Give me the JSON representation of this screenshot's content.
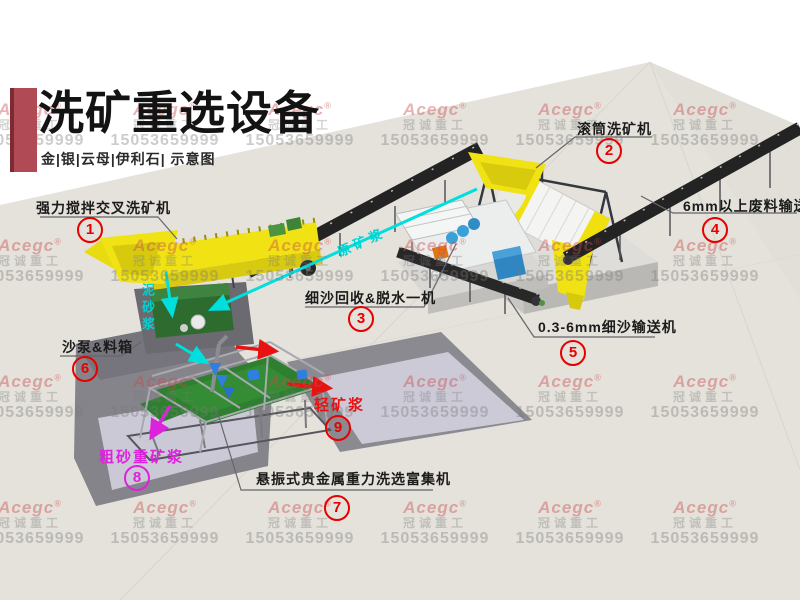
{
  "title_block": {
    "title": "洗矿重选设备",
    "subtitle": "金|银|云母|伊利石| 示意图"
  },
  "watermark": {
    "brand": "Acegc",
    "reg": "®",
    "company": "冠诚重工",
    "phone": "15053659999"
  },
  "labels": {
    "l1": {
      "num": "1",
      "text": "强力搅拌交叉洗矿机"
    },
    "l2": {
      "num": "2",
      "text": "滚筒洗矿机"
    },
    "l3": {
      "num": "3",
      "text": "细沙回收&脱水一机"
    },
    "l4": {
      "num": "4",
      "text": "6mm以上废料输送机"
    },
    "l5": {
      "num": "5",
      "text": "0.3-6mm细沙输送机"
    },
    "l6": {
      "num": "6",
      "text": "沙泵&料箱"
    },
    "l7": {
      "num": "7",
      "text": "悬振式贵金属重力洗选富集机"
    },
    "l8": {
      "num": "8",
      "text": "粗砂重矿浆"
    },
    "l9": {
      "num": "9",
      "text": "轻矿浆"
    }
  },
  "flows": {
    "raw_slurry": "原矿浆",
    "mud_slurry": "泥砂浆"
  },
  "colors": {
    "accent_red": "#b04b55",
    "label_red": "#e60000",
    "magenta": "#dd22dd",
    "cyan": "#00d2d2",
    "machine_yellow": "#f0e213",
    "deck_green": "#2e8030",
    "conveyor_black": "#232323"
  }
}
